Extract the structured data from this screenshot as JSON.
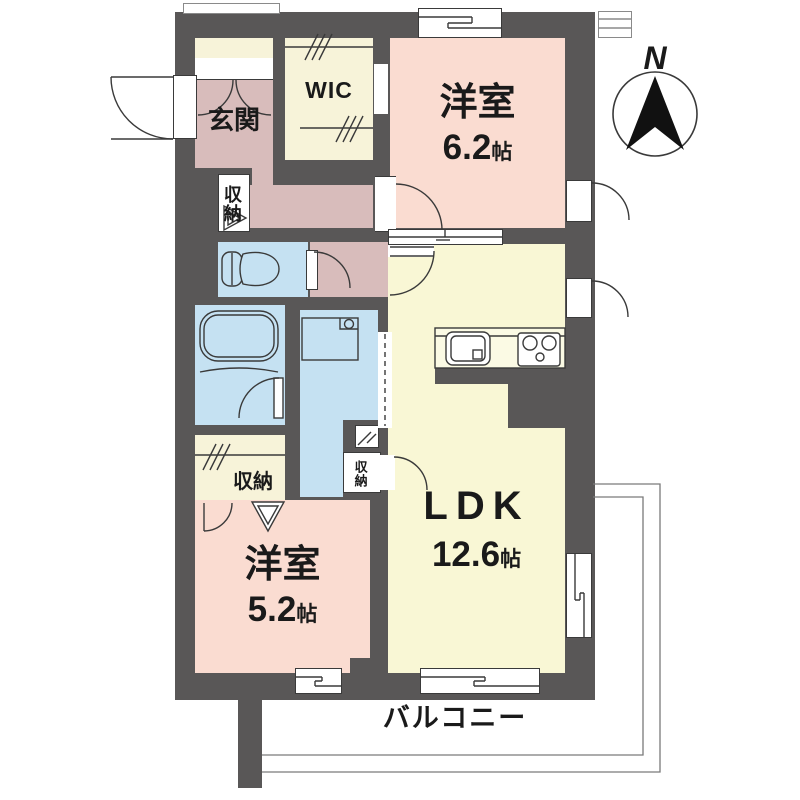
{
  "plan_type": "floorplan",
  "rooms": {
    "genkan": {
      "label": "玄関"
    },
    "wic": {
      "label": "WIC"
    },
    "bedroom1": {
      "label": "洋室",
      "size": "6.2",
      "size_unit": "帖"
    },
    "ldk": {
      "label": "LDK",
      "size": "12.6",
      "size_unit": "帖"
    },
    "bedroom2": {
      "label": "洋室",
      "size": "5.2",
      "size_unit": "帖"
    },
    "balcony": {
      "label": "バルコニー"
    },
    "hall_storage": {
      "label": "収納"
    },
    "bedroom2_storage": {
      "label": "収納"
    },
    "ldk_storage": {
      "label": "収納"
    }
  },
  "compass": {
    "north": "N"
  },
  "icons": {
    "compass": "north-arrow-icon",
    "toilet": "toilet-icon",
    "bathtub": "bathtub-icon",
    "washer_pan": "washing-machine-pan-icon",
    "kitchen_sink": "kitchen-sink-icon",
    "stove": "gas-stove-icon"
  },
  "colors": {
    "wall": "#595757",
    "bedroom_pink": "#fadcd1",
    "ldk_yellow": "#f9f7d5",
    "wet_area_blue": "#c5e1f2",
    "hall_mauve": "#d8bcbb",
    "storage_cream": "#f7f3d9",
    "outline": "#3a3a3a"
  }
}
